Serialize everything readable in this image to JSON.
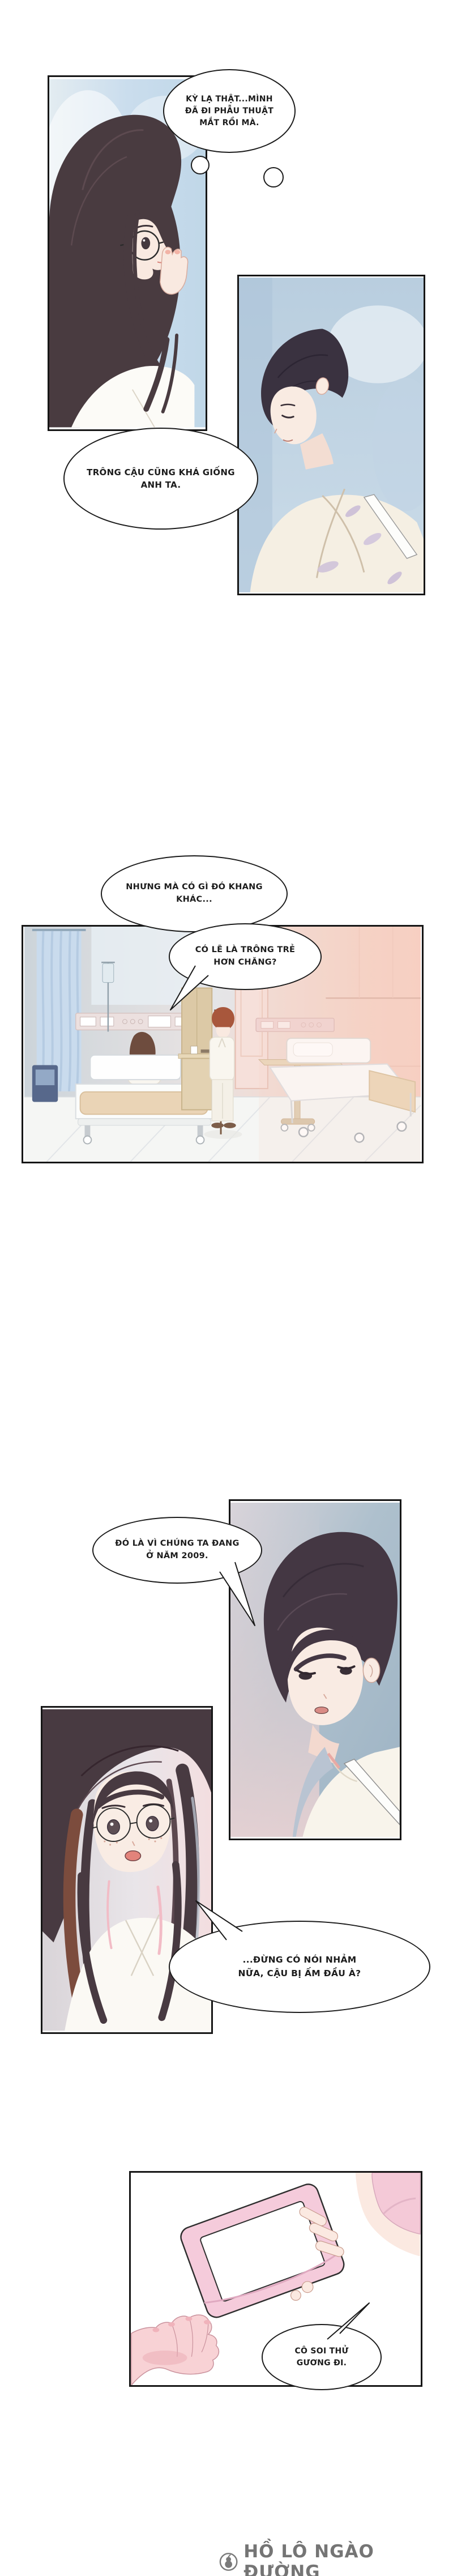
{
  "comic": {
    "bubbles": {
      "thought_eye_surgery": {
        "type": "thought",
        "lines": [
          "KỲ LẠ THẬT...MÌNH",
          "ĐÃ ĐI PHẪU THUẬT",
          "MẮT RỒI MÀ."
        ]
      },
      "looks_like_him": {
        "type": "speech",
        "lines": [
          "TRÔNG CẬU CŨNG KHÁ GIỐNG",
          "ANH TA."
        ]
      },
      "something_off": {
        "type": "speech",
        "lines": [
          "NHƯNG MÀ CÓ GÌ ĐÓ KHANG",
          "KHÁC..."
        ]
      },
      "looks_younger": {
        "type": "speech",
        "lines": [
          "CÓ LẼ LÀ TRÔNG TRẺ",
          "HƠN CHĂNG?"
        ]
      },
      "year_2009": {
        "type": "speech",
        "lines": [
          "ĐÓ LÀ VÌ CHÚNG TA ĐANG",
          "Ở NĂM 2009."
        ]
      },
      "stop_nonsense": {
        "type": "speech",
        "lines": [
          "...ĐỪNG CÓ NÓI NHẢM",
          "NỮA, CẬU BỊ ẤM ĐẦU À?"
        ]
      },
      "try_mirror": {
        "type": "speech",
        "lines": [
          "CÔ SOI THỬ",
          "GƯƠNG ĐI."
        ]
      }
    },
    "footer": {
      "credit": "HỒ LÔ NGÀO ĐƯỜNG",
      "icon": "gourd-logo-icon",
      "text_color": "#757575"
    },
    "palette": {
      "page_bg": "#ffffff",
      "panel_border": "#161616",
      "bubble_outline": "#1b1b1b",
      "panel1_bg_blue": "#cadded",
      "panel2_bg_blue": "#b9cedf",
      "hair_dark_plum": "#463843",
      "hair_auburn": "#a8573c",
      "hair_brown": "#6e4c3e",
      "skin_pale": "#f9e9e0",
      "gown_cream": "#f5efe3",
      "hospital_wall_blue": "#ccd4da",
      "hospital_wall_pink": "#f7cfc2",
      "curtain_blue": "#c9dbed",
      "bed_pad_tan": "#ead4b6",
      "phone_pink": "#f5cbdb",
      "hand_pink": "#f8d2d5"
    }
  }
}
